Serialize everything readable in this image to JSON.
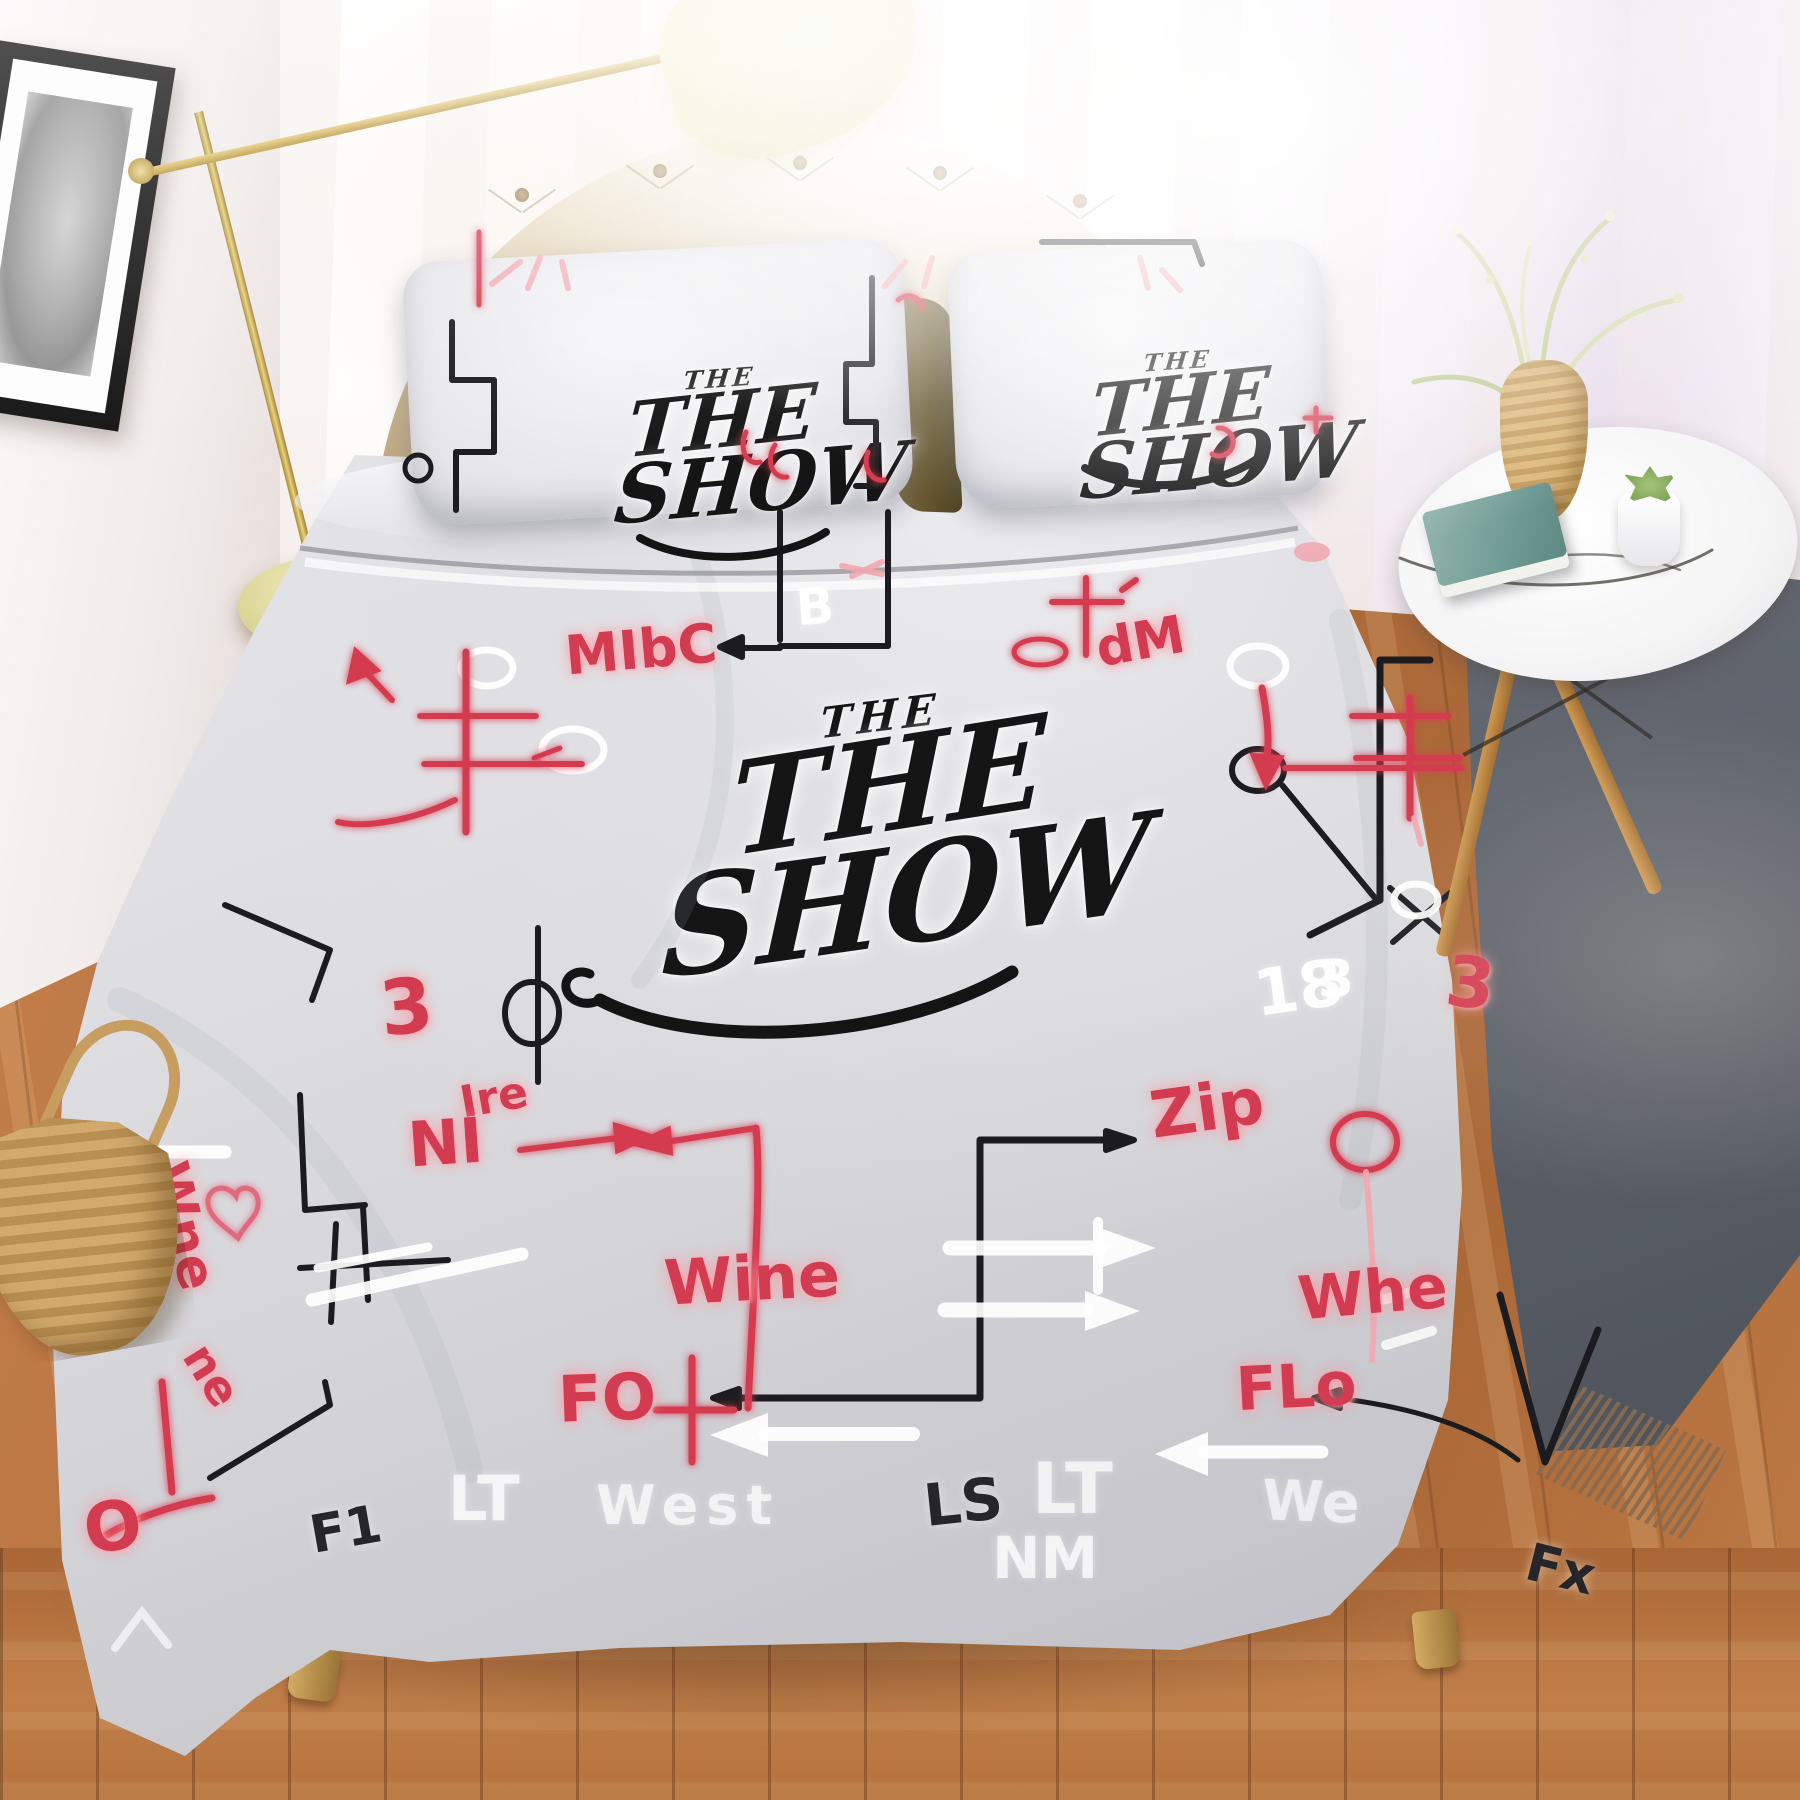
{
  "logo": {
    "the_small": "THE",
    "the": "THE",
    "show": "SHOW"
  },
  "annotations": {
    "red": [
      {
        "text": "MIbC"
      },
      {
        "text": "dM"
      },
      {
        "text": "Ire"
      },
      {
        "text": "NI"
      },
      {
        "text": "Wine"
      },
      {
        "text": "Zip"
      },
      {
        "text": "Whe"
      },
      {
        "text": "FLo"
      },
      {
        "text": "FO"
      },
      {
        "text": "3"
      },
      {
        "text": "3"
      },
      {
        "text": "O"
      },
      {
        "text": "Wne"
      },
      {
        "text": "ne"
      }
    ],
    "white": [
      {
        "text": "18"
      },
      {
        "text": "B"
      },
      {
        "text": "West"
      },
      {
        "text": "We"
      },
      {
        "text": "NM"
      },
      {
        "text": "LT"
      },
      {
        "text": "LT"
      },
      {
        "text": "3"
      }
    ],
    "black": [
      {
        "text": "LS"
      },
      {
        "text": "F1"
      },
      {
        "text": "Fx"
      }
    ]
  },
  "colors": {
    "duvet": "#dfdfe3",
    "red_ink": "#d23b50",
    "rug": "#5b6069",
    "wood_floor": "#b87342",
    "headboard": "#ddcaa7",
    "lamp_gold": "#c9a84c",
    "book_teal": "#6f9a94"
  }
}
